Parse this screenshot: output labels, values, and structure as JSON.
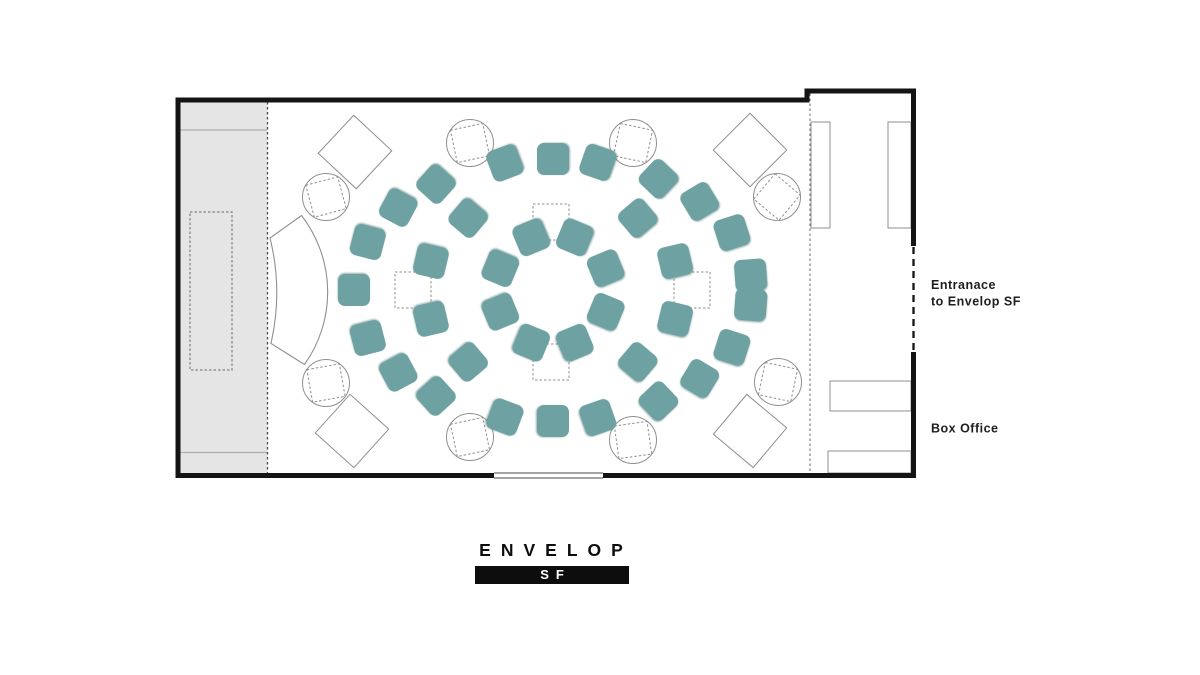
{
  "logo": {
    "name": "ENVELOP",
    "badge": "SF"
  },
  "labels": {
    "entrance_line1": "Entranace",
    "entrance_line2": "to Envelop SF",
    "box_office": "Box Office"
  },
  "colors": {
    "seat": "#6EA1A1",
    "wall": "#141414",
    "line": "#8f8f8f",
    "dark_line": "#4a4a4a",
    "mid_line": "#6a6a6a",
    "stage_fill": "#e4e5e4",
    "stage_line": "#aab0aa",
    "logo_box": "#0d0d0d",
    "label_text": "#1f1f1f"
  },
  "floorplan": {
    "center": {
      "x": 553,
      "y": 290
    },
    "seat_size": 32,
    "sub_size": 36,
    "rings": [
      {
        "name": "outer",
        "rx": 199,
        "ry": 131,
        "angles": [
          6.5,
          26,
          42.5,
          58,
          77,
          90,
          104,
          126,
          141,
          158.5,
          180,
          201.5,
          219,
          234,
          256,
          270,
          283,
          302,
          317.5,
          334,
          353.5
        ]
      },
      {
        "name": "middle",
        "rx": 128,
        "ry": 96,
        "angles": [
          17.5,
          48.5,
          131.5,
          162.5,
          197.5,
          228.5,
          311.5,
          342.5
        ]
      },
      {
        "name": "inner",
        "rx": 57,
        "ry": 57,
        "angles": [
          22.5,
          67.5,
          112.5,
          157.5,
          202.5,
          247.5,
          292.5,
          337.5
        ]
      }
    ],
    "subwoofers": [
      {
        "x": 551,
        "y": 222
      },
      {
        "x": 551,
        "y": 362
      },
      {
        "x": 413,
        "y": 290
      },
      {
        "x": 692,
        "y": 290
      }
    ],
    "speakers": [
      {
        "x": 326,
        "y": 197,
        "rot": -15
      },
      {
        "x": 470,
        "y": 143,
        "rot": -12
      },
      {
        "x": 633,
        "y": 143,
        "rot": 12
      },
      {
        "x": 777,
        "y": 197,
        "rot": 40
      },
      {
        "x": 326,
        "y": 383,
        "rot": -10
      },
      {
        "x": 470,
        "y": 437,
        "rot": -12
      },
      {
        "x": 633,
        "y": 440,
        "rot": -8
      },
      {
        "x": 778,
        "y": 382,
        "rot": 12
      }
    ],
    "diamonds": [
      {
        "x": 355,
        "y": 152,
        "rot": 43
      },
      {
        "x": 750,
        "y": 150,
        "rot": 45
      },
      {
        "x": 352,
        "y": 431,
        "rot": 42
      },
      {
        "x": 750,
        "y": 431,
        "rot": 40
      }
    ],
    "vestibule_rects": [
      {
        "x": 811,
        "y": 122,
        "w": 19,
        "h": 106
      },
      {
        "x": 888,
        "y": 122,
        "w": 23,
        "h": 106
      },
      {
        "x": 830,
        "y": 381,
        "w": 81,
        "h": 30
      },
      {
        "x": 828,
        "y": 451,
        "w": 83,
        "h": 22
      }
    ]
  }
}
